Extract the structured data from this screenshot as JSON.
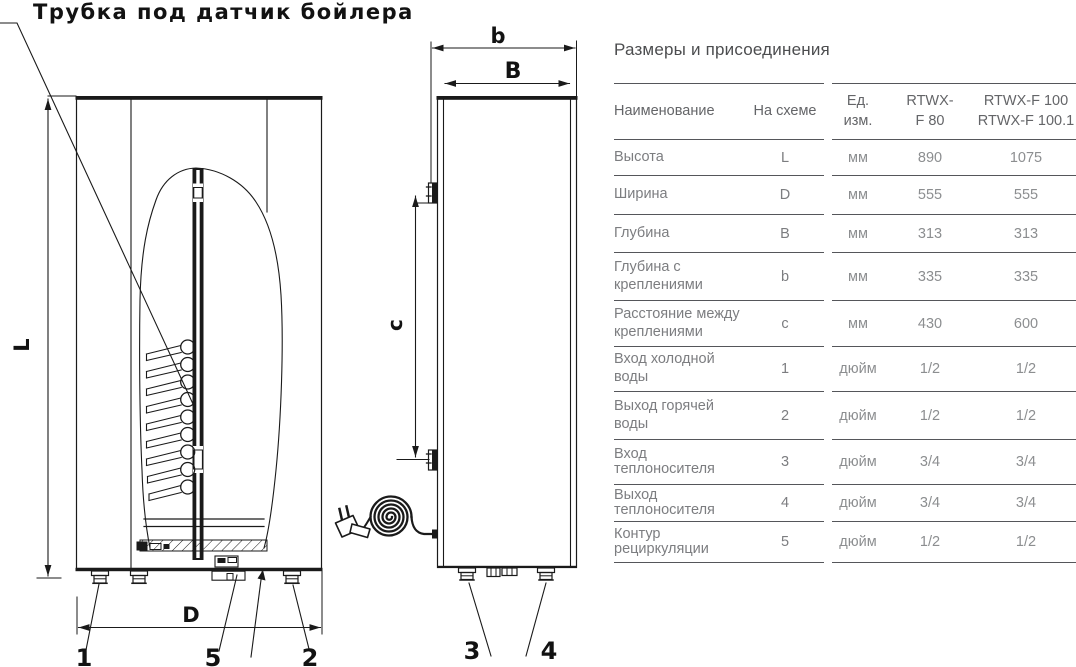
{
  "drawing": {
    "callout": "Трубка под датчик бойлера",
    "dims": {
      "L": "L",
      "D": "D",
      "B": "B",
      "b": "b",
      "c": "c"
    },
    "ports": {
      "p1": "1",
      "p2": "2",
      "p3": "3",
      "p4": "4",
      "p5": "5"
    }
  },
  "table": {
    "title": "Размеры и присоединения",
    "columns": [
      "Наименование",
      "На схеме",
      "Ед. изм.",
      "RTWX-\nF 80",
      "RTWX-F 100\nRTWX-F 100.1"
    ],
    "rows": [
      [
        "Высота",
        "L",
        "мм",
        "890",
        "1075"
      ],
      [
        "Ширина",
        "D",
        "мм",
        "555",
        "555"
      ],
      [
        "Глубина",
        "B",
        "мм",
        "313",
        "313"
      ],
      [
        "Глубина с креплениями",
        "b",
        "мм",
        "335",
        "335"
      ],
      [
        "Расстояние между креплениями",
        "c",
        "мм",
        "430",
        "600"
      ],
      [
        "Вход холодной воды",
        "1",
        "дюйм",
        "1/2",
        "1/2"
      ],
      [
        "Выход горячей воды",
        "2",
        "дюйм",
        "1/2",
        "1/2"
      ],
      [
        "Вход теплоносителя",
        "3",
        "дюйм",
        "3/4",
        "3/4"
      ],
      [
        "Выход теплоносителя",
        "4",
        "дюйм",
        "3/4",
        "3/4"
      ],
      [
        "Контур рециркуляции",
        "5",
        "дюйм",
        "1/2",
        "1/2"
      ]
    ]
  },
  "colors": {
    "line": "#1a1a1a",
    "table_rule": "#55565a",
    "table_label": "#7c7d80",
    "table_value": "#8c8e90"
  }
}
